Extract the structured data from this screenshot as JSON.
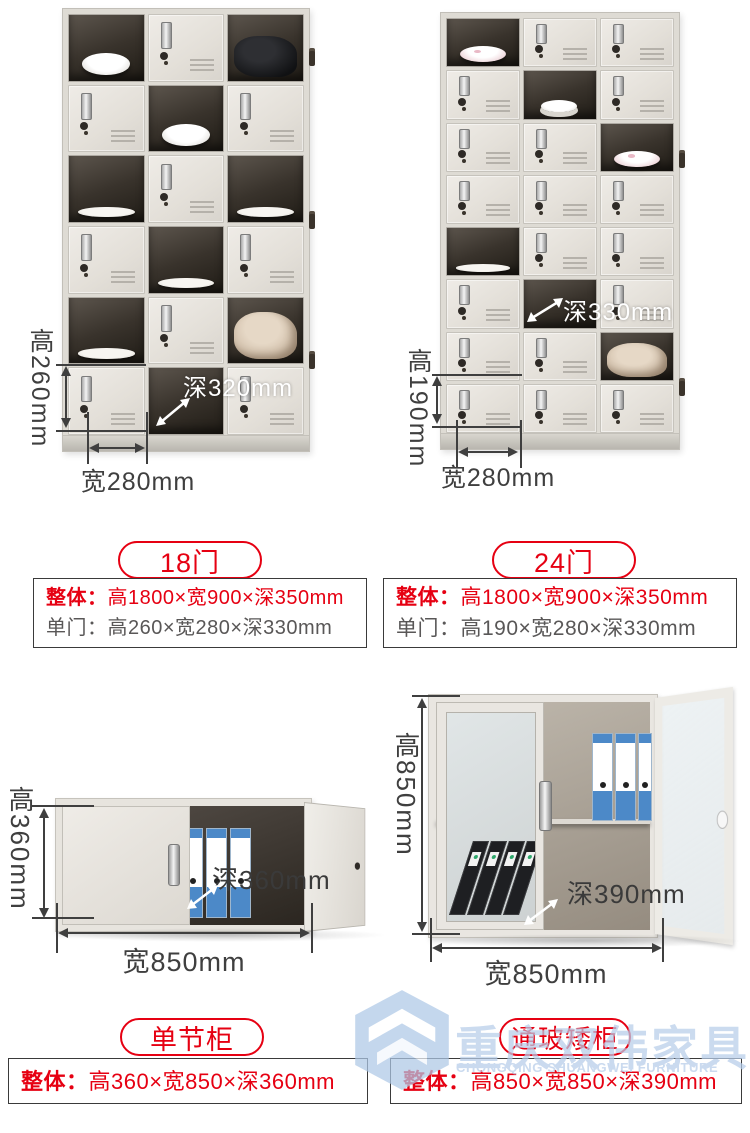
{
  "colors": {
    "accent_red": "#e60012",
    "dimension_text": "#3f3f3f",
    "spec_gray": "#595757",
    "watermark_blue": "#b7cde9",
    "locker_body": "#e7e4de"
  },
  "products": {
    "locker18": {
      "pill_label": "18门",
      "spec": [
        {
          "label": "整体：",
          "value": "高1800×宽900×深350mm"
        },
        {
          "label": "单门：",
          "value": "高260×宽280×深330mm"
        }
      ],
      "dims": {
        "height": "高260mm",
        "width": "宽280mm",
        "depth": "深320mm"
      },
      "grid": {
        "rows": 6,
        "cols": 3,
        "open_cells": [
          {
            "r": 0,
            "c": 0,
            "item": "bowl"
          },
          {
            "r": 0,
            "c": 2,
            "item": "black-bag"
          },
          {
            "r": 1,
            "c": 1,
            "item": "bowl"
          },
          {
            "r": 2,
            "c": 0,
            "item": "plate"
          },
          {
            "r": 2,
            "c": 2,
            "item": "plate"
          },
          {
            "r": 3,
            "c": 1,
            "item": "plate"
          },
          {
            "r": 4,
            "c": 0,
            "item": "plate"
          },
          {
            "r": 4,
            "c": 2,
            "item": "beige-bag"
          },
          {
            "r": 5,
            "c": 1,
            "item": "empty"
          }
        ]
      }
    },
    "locker24": {
      "pill_label": "24门",
      "spec": [
        {
          "label": "整体：",
          "value": "高1800×宽900×深350mm"
        },
        {
          "label": "单门：",
          "value": "高190×宽280×深330mm"
        }
      ],
      "dims": {
        "height": "高190mm",
        "width": "宽280mm",
        "depth": "深330mm"
      },
      "grid": {
        "rows": 8,
        "cols": 3,
        "open_cells": [
          {
            "r": 0,
            "c": 0,
            "item": "floral-bowl"
          },
          {
            "r": 1,
            "c": 1,
            "item": "cup"
          },
          {
            "r": 2,
            "c": 2,
            "item": "floral-bowl"
          },
          {
            "r": 4,
            "c": 0,
            "item": "plate"
          },
          {
            "r": 5,
            "c": 1,
            "item": "empty"
          },
          {
            "r": 6,
            "c": 2,
            "item": "beige-bag"
          }
        ]
      }
    },
    "cabinet_single": {
      "pill_label": "单节柜",
      "spec": [
        {
          "label": "整体：",
          "value": "高360×宽850×深360mm"
        }
      ],
      "dims": {
        "height": "高360mm",
        "width": "宽850mm",
        "depth": "深360mm"
      }
    },
    "cabinet_glass": {
      "pill_label": "通玻矮柜",
      "spec": [
        {
          "label": "整体：",
          "value": "高850×宽850×深390mm"
        }
      ],
      "dims": {
        "height": "高850mm",
        "width": "宽850mm",
        "depth": "深390mm"
      }
    }
  },
  "watermark": {
    "cn": "重庆双伟家具",
    "en": "CHONGQING SHUANGWEI FURNITURE"
  }
}
